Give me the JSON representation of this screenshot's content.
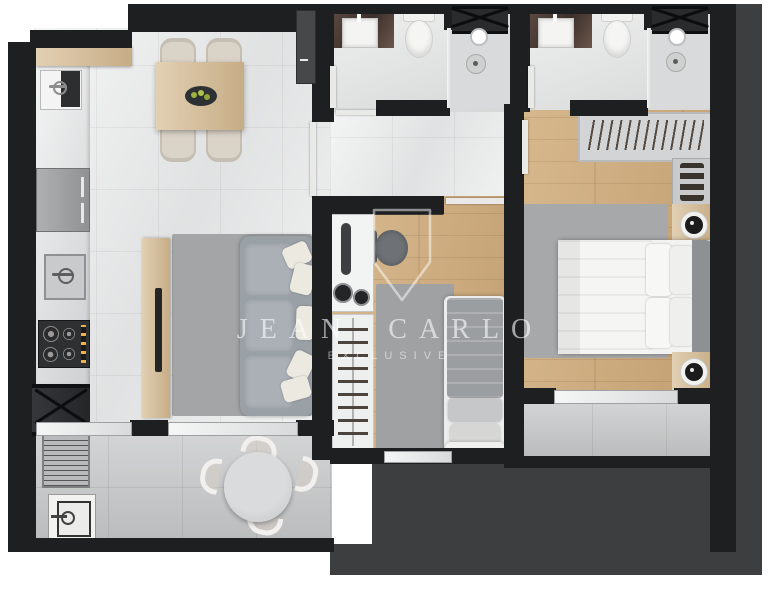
{
  "watermark": {
    "brand": "JEAN CARLO",
    "tagline": "EXCLUSIVE"
  },
  "palette": {
    "background": "#ffffff",
    "walls": "#1d1f21",
    "exterior_slab": "#3c3e40",
    "marble_floor": "#ebecec",
    "bathroom_floor": "#e0e1e1",
    "wood_floor": "#cba97c",
    "paver_floor": "#c6c7c8",
    "rug": "#a3a5a7",
    "sofa": "#99a0a6",
    "bathroom_counter_stone": "#54453e",
    "furniture_wood": "#d8c09a",
    "bedding_white": "#f3f3f2",
    "watermark_white": "rgba(255,255,255,0.6)",
    "fruit_green": "#9cb23c"
  },
  "legend": {
    "areas": [
      "kitchen",
      "dining-area",
      "living-room",
      "bathroom-1",
      "bathroom-2",
      "hallway",
      "master-bedroom",
      "second-bedroom",
      "service-area",
      "terrace",
      "balcony"
    ],
    "fixtures": [
      "kitchen-sink",
      "fridge",
      "prep-sink",
      "gas-cooktop",
      "duct-shaft-x",
      "grill",
      "terrace-sink",
      "dining-table-with-fruit-bowl",
      "dining-chairs",
      "tv-console",
      "tv",
      "sofa-with-pillows",
      "round-terrace-table",
      "terrace-chairs",
      "vanity-sink",
      "toilet",
      "shower-head",
      "floor-drain",
      "vent-shaft-x",
      "wardrobe-hangers",
      "shoe-shelf",
      "nightstand-lamp",
      "double-bed",
      "single-bed",
      "office-desk",
      "desk-chair",
      "washer",
      "ironing-board",
      "drying-rack",
      "sliding-window"
    ]
  }
}
